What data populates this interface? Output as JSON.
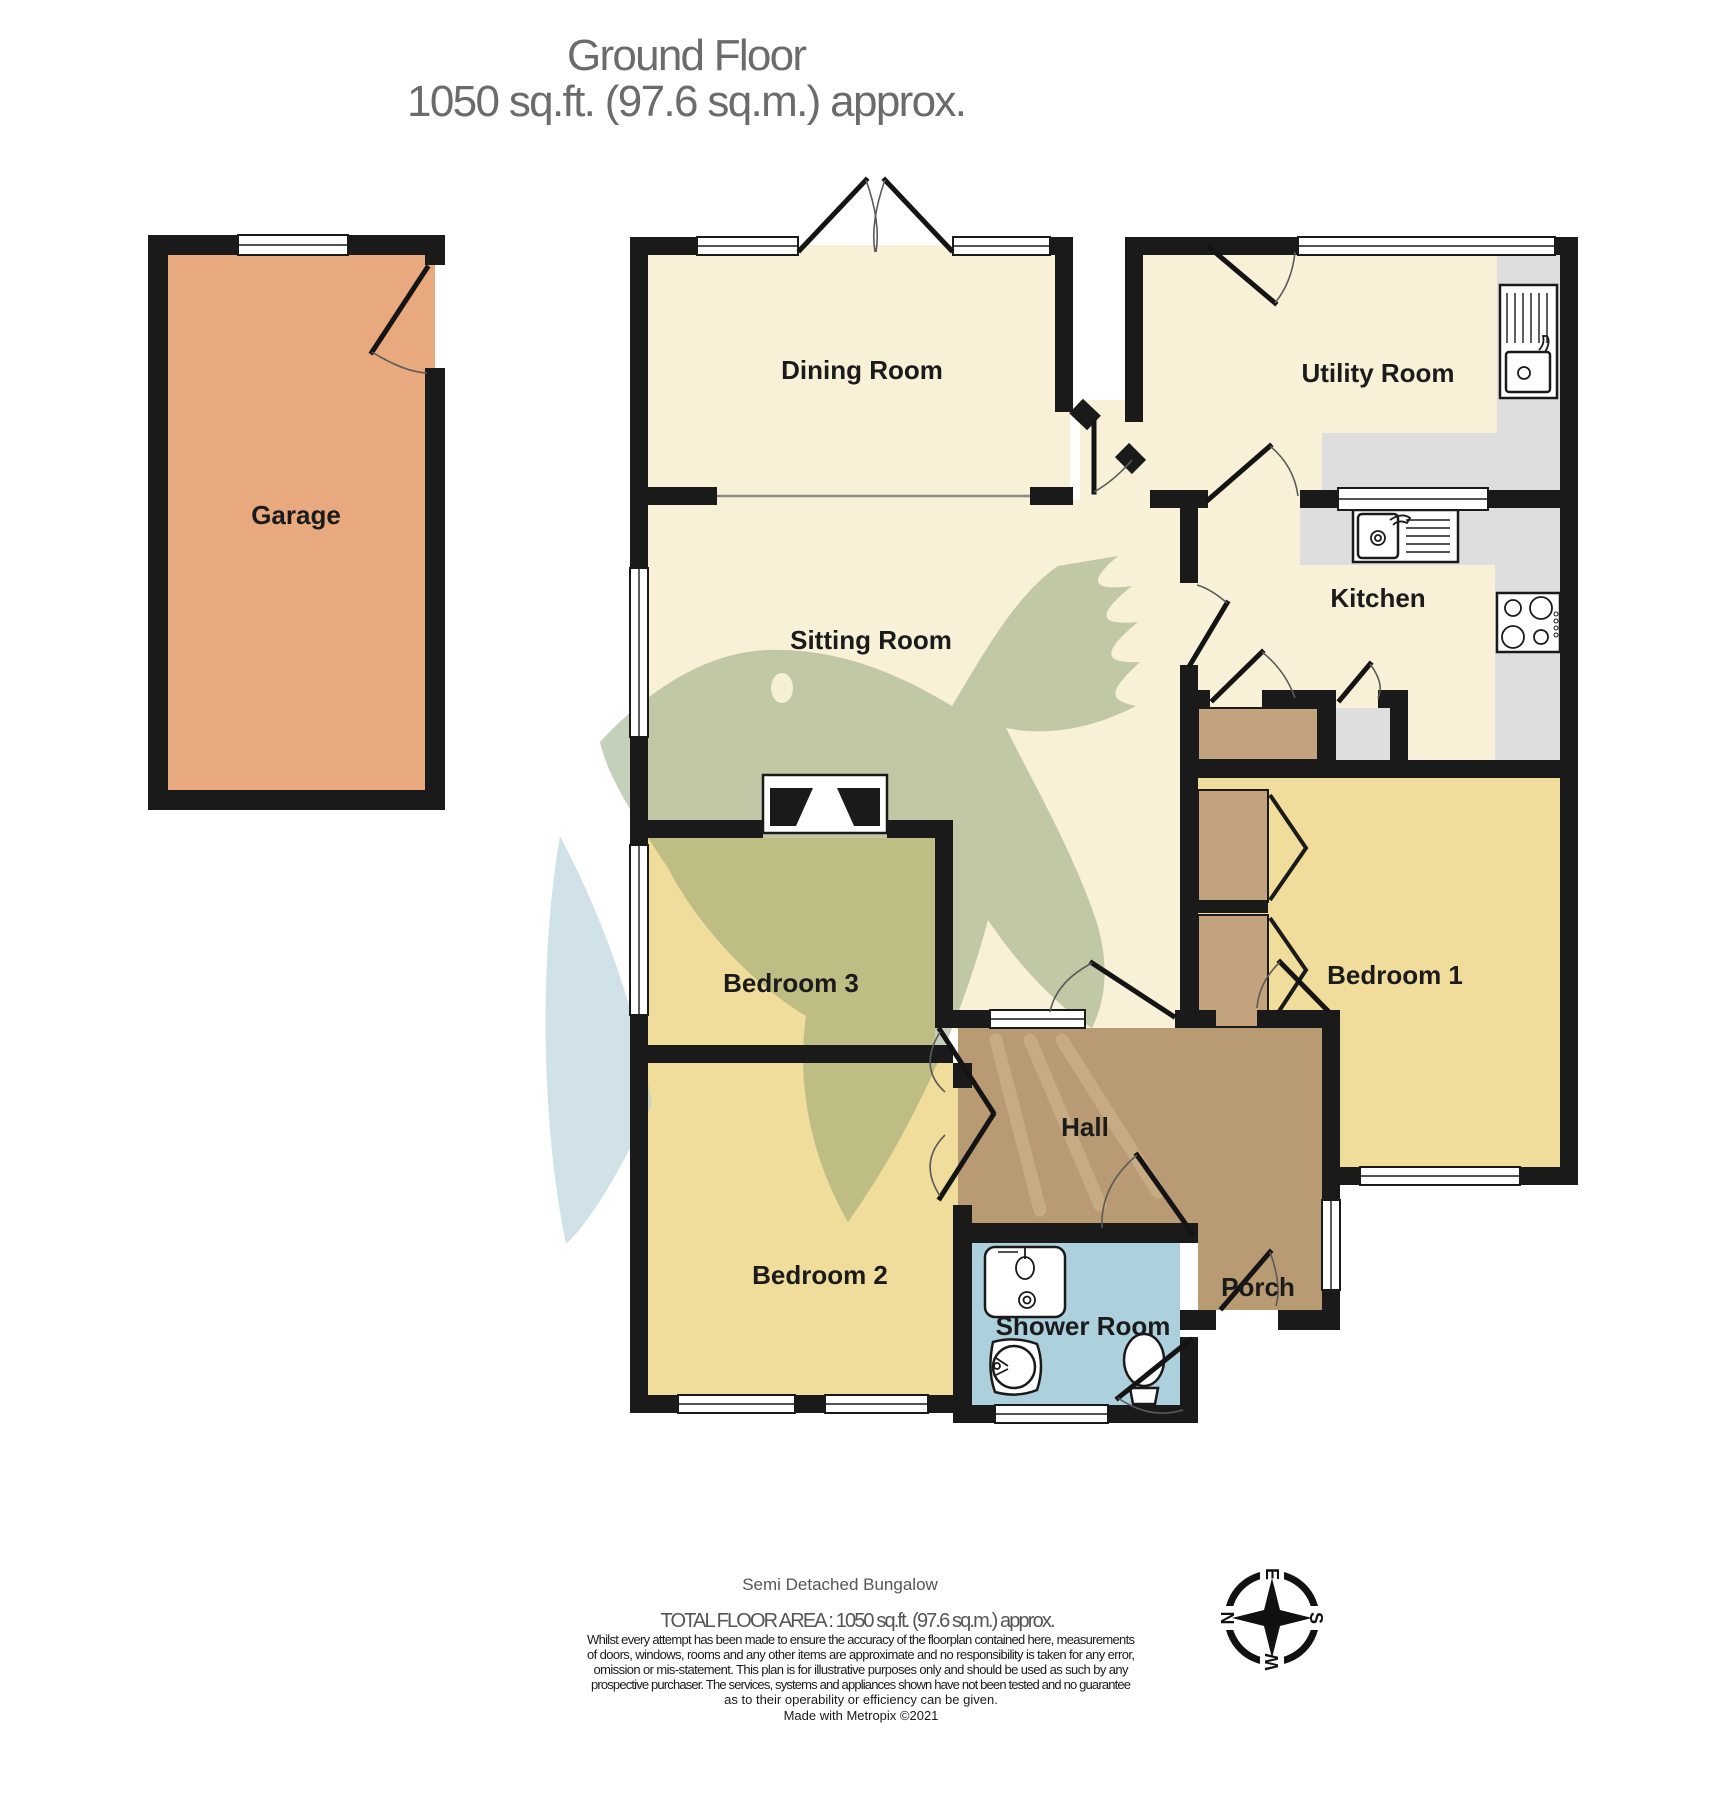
{
  "title": {
    "line1": "Ground Floor",
    "line2": "1050 sq.ft. (97.6 sq.m.) approx."
  },
  "rooms": [
    {
      "id": "garage",
      "label": "Garage"
    },
    {
      "id": "dining-room",
      "label": "Dining Room"
    },
    {
      "id": "utility-room",
      "label": "Utility Room"
    },
    {
      "id": "kitchen",
      "label": "Kitchen"
    },
    {
      "id": "sitting-room",
      "label": "Sitting Room"
    },
    {
      "id": "bedroom-1",
      "label": "Bedroom 1"
    },
    {
      "id": "bedroom-3",
      "label": "Bedroom 3"
    },
    {
      "id": "bedroom-2",
      "label": "Bedroom 2"
    },
    {
      "id": "hall",
      "label": "Hall"
    },
    {
      "id": "shower-room",
      "label": "Shower Room"
    },
    {
      "id": "porch",
      "label": "Porch"
    }
  ],
  "footer": {
    "property_type": "Semi Detached Bungalow",
    "total_area": "TOTAL FLOOR AREA : 1050 sq.ft. (97.6 sq.m.) approx.",
    "disclaimer": [
      "Whilst every attempt has been made to ensure the accuracy of the floorplan contained here, measurements",
      "of doors, windows, rooms and any other items are approximate and no responsibility is taken for any error,",
      "omission or mis-statement. This plan is for illustrative purposes only and should be used as such by any",
      "prospective purchaser. The services, systems and appliances shown have not been tested and no guarantee",
      "as to their operability or efficiency can be given.",
      "Made with Metropix ©2021"
    ]
  },
  "compass": {
    "n": "N",
    "e": "E",
    "s": "S",
    "w": "W"
  },
  "icons": [
    "utility-sink-icon",
    "kitchen-sink-icon",
    "hob-icon",
    "washbasin-icon",
    "shower-icon",
    "toilet-icon",
    "fireplace-icon",
    "compass-rose-icon",
    "bird-watermark-icon"
  ],
  "colors": {
    "wall": "#1a1a1a",
    "garage_fill": "#E9A97E",
    "cream_fill": "#F8F1D7",
    "bedroom_fill": "#F0DD9B",
    "hall_fill": "#B89B72",
    "shower_fill": "#ADD0DD",
    "counter_fill": "#DEDEDE",
    "wardrobe_fill": "#C3A37E",
    "watermark_green": "#7F9669",
    "watermark_blue": "#A9CBD4",
    "title_gray": "#6b6b6b"
  }
}
